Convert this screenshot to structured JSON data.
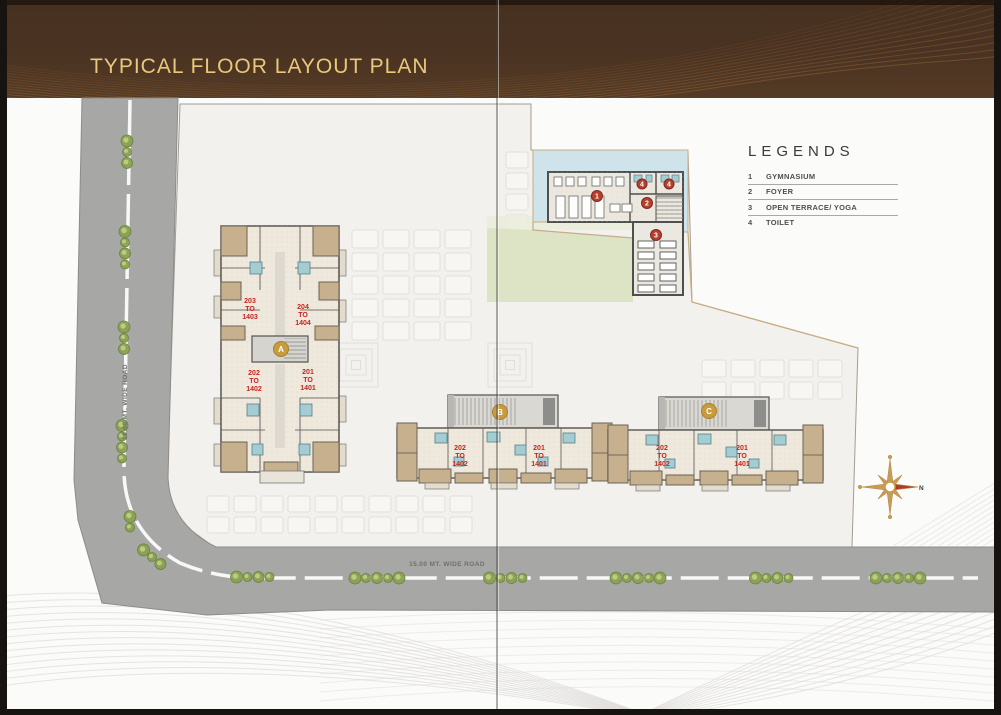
{
  "header": {
    "title": "TYPICAL FLOOR LAYOUT PLAN"
  },
  "legends": {
    "title": "LEGENDS",
    "items": [
      {
        "num": "1",
        "label": "GYMNASIUM"
      },
      {
        "num": "2",
        "label": "FOYER"
      },
      {
        "num": "3",
        "label": "OPEN TERRACE/ YOGA"
      },
      {
        "num": "4",
        "label": "TOILET"
      }
    ]
  },
  "roads": {
    "bottom_label": "15.00 MT. WIDE ROAD",
    "left_label": "18.00 MT. WIDE ROAD"
  },
  "buildings": {
    "a": {
      "badge": "A",
      "units": [
        {
          "lines": [
            "203",
            "TO",
            "1403"
          ]
        },
        {
          "lines": [
            "204",
            "TO",
            "1404"
          ]
        },
        {
          "lines": [
            "202",
            "TO",
            "1402"
          ]
        },
        {
          "lines": [
            "201",
            "TO",
            "1401"
          ]
        }
      ]
    },
    "b": {
      "badge": "B",
      "units": [
        {
          "lines": [
            "202",
            "TO",
            "1402"
          ]
        },
        {
          "lines": [
            "201",
            "TO",
            "1401"
          ]
        }
      ]
    },
    "c": {
      "badge": "C",
      "units": [
        {
          "lines": [
            "202",
            "TO",
            "1402"
          ]
        },
        {
          "lines": [
            "201",
            "TO",
            "1401"
          ]
        }
      ]
    }
  },
  "amenity_markers": {
    "gym": "1",
    "foyer": "2",
    "terrace": "3",
    "toilet_a": "4",
    "toilet_b": "4"
  },
  "compass": {
    "north": "N"
  },
  "colors": {
    "header_bg": "#4a3322",
    "header_title": "#e9c87c",
    "road": "#a7a7a5",
    "site": "#f2f1ee",
    "lawn": "#dde4c6",
    "pool_deck": "#cfe3ea",
    "tan_wall": "#c7b08d",
    "unit_red": "#c6241f",
    "badge_gold": "#c79b3e",
    "marker_red": "#b5402f",
    "tree_green": "#8ba14f"
  }
}
